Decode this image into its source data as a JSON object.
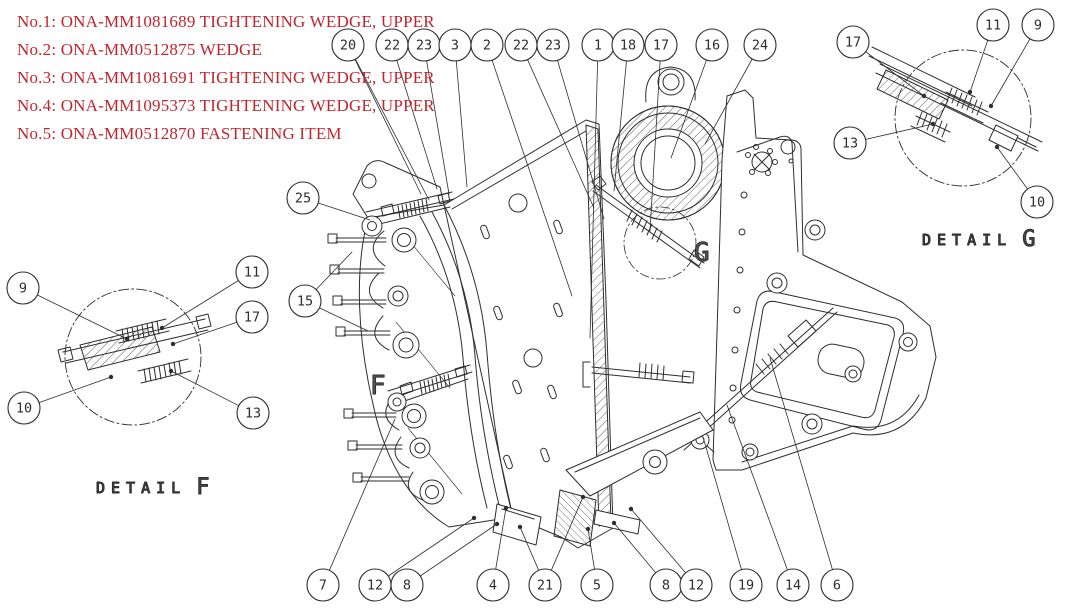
{
  "colors": {
    "parts_list": "#c2252e",
    "line": "#2e2e2e"
  },
  "parts_list": [
    "No.1: ONA-MM1081689 TIGHTENING WEDGE, UPPER",
    "No.2: ONA-MM0512875 WEDGE",
    "No.3: ONA-MM1081691 TIGHTENING WEDGE, UPPER",
    "No.4: ONA-MM1095373 TIGHTENING WEDGE, UPPER",
    "No.5: ONA-MM0512870 FASTENING ITEM"
  ],
  "details": {
    "f": {
      "label": "DETAIL",
      "letter": "F"
    },
    "g": {
      "label": "DETAIL",
      "letter": "G"
    }
  },
  "markers": {
    "f": "F",
    "g": "G"
  },
  "balloon_style": {
    "radius": 16
  },
  "balloons": [
    {
      "label": "20",
      "x": 348,
      "y": 45,
      "leaders": [
        [
          421,
          194
        ],
        [
          429,
          200
        ]
      ]
    },
    {
      "label": "22",
      "x": 392,
      "y": 45,
      "leaders": [
        [
          437,
          189
        ]
      ]
    },
    {
      "label": "23",
      "x": 424,
      "y": 45,
      "leaders": [
        [
          449,
          194
        ]
      ]
    },
    {
      "label": "3",
      "x": 455,
      "y": 45,
      "leaders": [
        [
          467,
          187
        ]
      ]
    },
    {
      "label": "2",
      "x": 487,
      "y": 45,
      "leaders": [
        [
          572,
          296
        ]
      ]
    },
    {
      "label": "22",
      "x": 521,
      "y": 45,
      "leaders": [
        [
          594,
          208
        ]
      ]
    },
    {
      "label": "23",
      "x": 553,
      "y": 45,
      "leaders": [
        [
          604,
          219
        ]
      ]
    },
    {
      "label": "1",
      "x": 598,
      "y": 45,
      "leaders": [
        [
          590,
          338
        ]
      ]
    },
    {
      "label": "18",
      "x": 628,
      "y": 45,
      "leaders": [
        [
          614,
          191
        ]
      ]
    },
    {
      "label": "17",
      "x": 661,
      "y": 45,
      "leaders": [
        [
          650,
          231
        ]
      ]
    },
    {
      "label": "16",
      "x": 712,
      "y": 45,
      "leaders": [
        [
          671,
          158
        ]
      ]
    },
    {
      "label": "24",
      "x": 760,
      "y": 45,
      "leaders": [
        [
          705,
          144
        ]
      ]
    },
    {
      "label": "25",
      "x": 303,
      "y": 198,
      "leaders": [
        [
          370,
          220
        ]
      ]
    },
    {
      "label": "15",
      "x": 305,
      "y": 301,
      "leaders": [
        [
          352,
          252
        ],
        [
          368,
          331
        ]
      ]
    },
    {
      "label": "7",
      "x": 323,
      "y": 585,
      "leaders": [
        [
          395,
          419
        ]
      ]
    },
    {
      "label": "12",
      "x": 375,
      "y": 585,
      "leaders": [
        [
          474,
          518
        ]
      ],
      "dot": true
    },
    {
      "label": "8",
      "x": 407,
      "y": 585,
      "leaders": [
        [
          497,
          524
        ]
      ],
      "dot": true
    },
    {
      "label": "4",
      "x": 493,
      "y": 585,
      "leaders": [
        [
          506,
          508
        ]
      ],
      "dot": true
    },
    {
      "label": "21",
      "x": 545,
      "y": 585,
      "leaders": [
        [
          520,
          527
        ],
        [
          583,
          497
        ]
      ],
      "dot": true
    },
    {
      "label": "5",
      "x": 597,
      "y": 585,
      "leaders": [
        [
          588,
          529
        ]
      ],
      "dot": true
    },
    {
      "label": "8",
      "x": 666,
      "y": 585,
      "leaders": [
        [
          614,
          523
        ]
      ],
      "dot": true
    },
    {
      "label": "12",
      "x": 696,
      "y": 585,
      "leaders": [
        [
          631,
          509
        ]
      ],
      "dot": true
    },
    {
      "label": "19",
      "x": 746,
      "y": 585,
      "leaders": [
        [
          703,
          437
        ]
      ]
    },
    {
      "label": "14",
      "x": 793,
      "y": 585,
      "leaders": [
        [
          727,
          405
        ]
      ]
    },
    {
      "label": "6",
      "x": 837,
      "y": 585,
      "leaders": [
        [
          770,
          358
        ]
      ]
    },
    {
      "label": "9",
      "x": 23,
      "y": 288,
      "leaders": [
        [
          127,
          339
        ]
      ],
      "dot": true
    },
    {
      "label": "11",
      "x": 252,
      "y": 272,
      "leaders": [
        [
          162,
          328
        ]
      ],
      "dot": true
    },
    {
      "label": "17",
      "x": 252,
      "y": 317,
      "leaders": [
        [
          173,
          344
        ]
      ],
      "dot": true
    },
    {
      "label": "10",
      "x": 24,
      "y": 408,
      "leaders": [
        [
          111,
          377
        ]
      ],
      "dot": true
    },
    {
      "label": "13",
      "x": 253,
      "y": 413,
      "leaders": [
        [
          171,
          371
        ]
      ],
      "dot": true
    },
    {
      "label": "17",
      "x": 853,
      "y": 42,
      "leaders": [
        [
          924,
          96
        ]
      ],
      "dot": true
    },
    {
      "label": "11",
      "x": 993,
      "y": 25,
      "leaders": [
        [
          970,
          92
        ]
      ],
      "dot": true
    },
    {
      "label": "9",
      "x": 1038,
      "y": 25,
      "leaders": [
        [
          991,
          106
        ]
      ],
      "dot": true
    },
    {
      "label": "13",
      "x": 850,
      "y": 143,
      "leaders": [
        [
          933,
          124
        ]
      ],
      "dot": true
    },
    {
      "label": "10",
      "x": 1037,
      "y": 202,
      "leaders": [
        [
          997,
          147
        ]
      ],
      "dot": true
    }
  ]
}
